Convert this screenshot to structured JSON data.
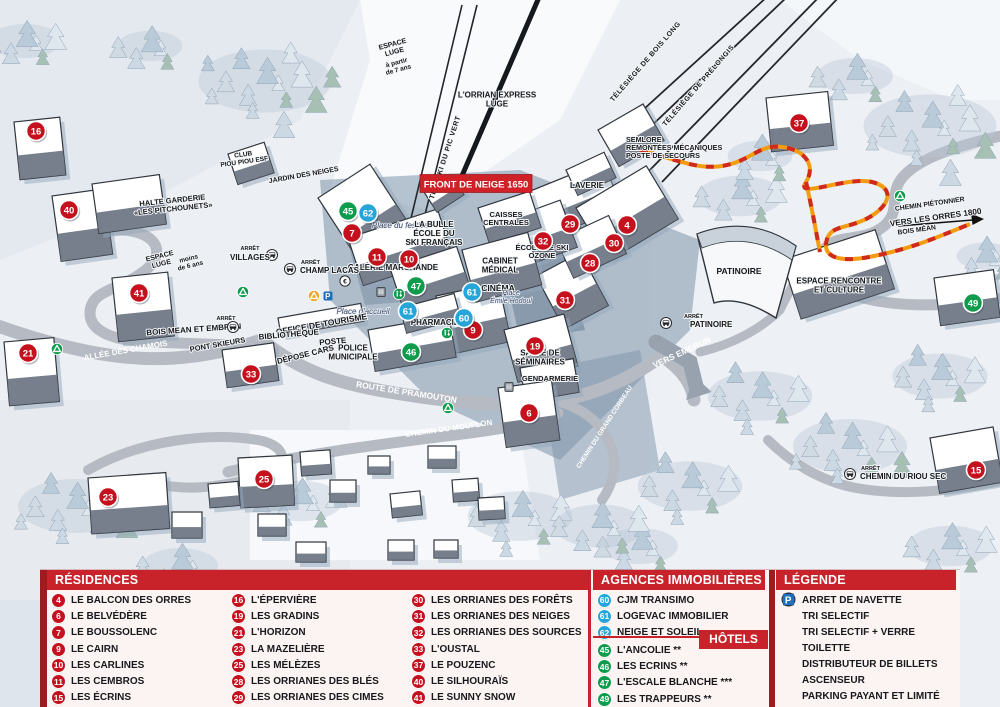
{
  "banner": {
    "text": "FRONT DE NEIGE 1650",
    "x": 476,
    "y": 184,
    "color": "#cf2128"
  },
  "arret_label": "ARRÊT",
  "colors": {
    "marker_red": "#c5111d",
    "marker_green": "#0e9c4c",
    "marker_blue": "#27a5d9",
    "header_red": "#c8232b",
    "dark_red": "#9e1b1f",
    "parking_blue": "#1e6fbd",
    "recycle_yellow": "#f0a52d",
    "path_orange": "#f39c12"
  },
  "map": {
    "labels": [
      {
        "t": [
          "ESPACE",
          "LUGE"
        ],
        "x": 394,
        "y": 50,
        "r": -15,
        "s": 7
      },
      {
        "t": [
          "à partir",
          "de 7 ans"
        ],
        "x": 398,
        "y": 68,
        "r": -15,
        "s": 6.5
      },
      {
        "t": [
          "TÉLÉSKI DU PIC VERT"
        ],
        "x": 447,
        "y": 158,
        "r": -72,
        "s": 7,
        "ls": 0.6
      },
      {
        "t": [
          "L'ORRIAN EXPRESS",
          "LUGE"
        ],
        "x": 497,
        "y": 102,
        "s": 8
      },
      {
        "t": [
          "TÉLÉSIÈGE DE BOIS LONG"
        ],
        "x": 647,
        "y": 63,
        "r": -49,
        "s": 7,
        "ls": 0.5
      },
      {
        "t": [
          "TÉLÉSIÈGE DE PRÉLONGIS"
        ],
        "x": 700,
        "y": 87,
        "r": -49,
        "s": 7,
        "ls": 0.5
      },
      {
        "t": [
          "SEMLORE",
          "REMONTÉES MÉCANIQUES",
          "POSTE DE SECOURS"
        ],
        "x": 626,
        "y": 150,
        "s": 7.2,
        "a": "start"
      },
      {
        "t": [
          "LAVERIE"
        ],
        "x": 587,
        "y": 188,
        "s": 8
      },
      {
        "t": [
          "HALTE GARDERIE",
          "«LES PITCHOUNETS»"
        ],
        "x": 173,
        "y": 207,
        "r": -6,
        "s": 7.5
      },
      {
        "t": [
          "CLUB",
          "PIOU PIOU ESF"
        ],
        "x": 244,
        "y": 160,
        "r": -8,
        "s": 6.5
      },
      {
        "t": [
          "JARDIN DES NEIGES"
        ],
        "x": 304,
        "y": 177,
        "r": -10,
        "s": 7
      },
      {
        "t": [
          "ESPACE",
          "LUGE"
        ],
        "x": 161,
        "y": 262,
        "r": -14,
        "s": 7
      },
      {
        "t": [
          "moins",
          "de 6 ans"
        ],
        "x": 190,
        "y": 264,
        "r": -14,
        "s": 6.5
      },
      {
        "t": [
          "Place du festival"
        ],
        "x": 401,
        "y": 228,
        "s": 8,
        "st": "p"
      },
      {
        "t": [
          "LA BULLE",
          "ÉCOLE DU",
          "SKI FRANÇAIS"
        ],
        "x": 434,
        "y": 236,
        "s": 8
      },
      {
        "t": [
          "CAISSES",
          "CENTRALES"
        ],
        "x": 506,
        "y": 221,
        "s": 7.5
      },
      {
        "t": [
          "GALERIE MARCHANDE"
        ],
        "x": 393,
        "y": 270,
        "s": 8
      },
      {
        "t": [
          "ÉCOLE DE SKI",
          "OZONE"
        ],
        "x": 542,
        "y": 254,
        "s": 7.5
      },
      {
        "t": [
          "CABINET",
          "MÉDICAL"
        ],
        "x": 500,
        "y": 268,
        "s": 8
      },
      {
        "t": [
          "CINÉMA"
        ],
        "x": 498,
        "y": 291,
        "s": 8.5
      },
      {
        "t": [
          "Place",
          "Émile Hodoul"
        ],
        "x": 511,
        "y": 299,
        "s": 7,
        "st": "p"
      },
      {
        "t": [
          "Place d'accueil"
        ],
        "x": 363,
        "y": 314,
        "s": 8,
        "st": "p"
      },
      {
        "t": [
          "OFFICE DE TOURISME"
        ],
        "x": 322,
        "y": 327,
        "r": -10,
        "s": 8.5
      },
      {
        "t": [
          "BIBLIOTHÈQUE"
        ],
        "x": 289,
        "y": 337,
        "r": -5,
        "s": 8
      },
      {
        "t": [
          "POSTE"
        ],
        "x": 333,
        "y": 344,
        "r": -5,
        "s": 8
      },
      {
        "t": [
          "DÉPOSE CARS"
        ],
        "x": 306,
        "y": 357,
        "r": -14,
        "s": 8
      },
      {
        "t": [
          "POLICE",
          "MUNICIPALE"
        ],
        "x": 353,
        "y": 355,
        "s": 8
      },
      {
        "t": [
          "PHARMACIE"
        ],
        "x": 435,
        "y": 325,
        "s": 8
      },
      {
        "t": [
          "SALLE DE",
          "SÉMINAIRES"
        ],
        "x": 540,
        "y": 360,
        "s": 8
      },
      {
        "t": [
          "GENDARMERIE"
        ],
        "x": 550,
        "y": 381,
        "s": 7.5
      },
      {
        "t": [
          "BOIS MEAN ET EMBRUN"
        ],
        "x": 194,
        "y": 332,
        "r": -4,
        "s": 8
      },
      {
        "t": [
          "PONT SKIEURS"
        ],
        "x": 218,
        "y": 347,
        "r": -10,
        "s": 7.5
      },
      {
        "t": [
          "ALLÉE DES CHAMOIS"
        ],
        "x": 126,
        "y": 353,
        "r": -10,
        "s": 8,
        "st": "w"
      },
      {
        "t": [
          "ROUTE DE PRAMOUTON"
        ],
        "x": 406,
        "y": 395,
        "r": 9,
        "s": 8.5,
        "st": "w"
      },
      {
        "t": [
          "CHEMIN DU MOUFLON"
        ],
        "x": 449,
        "y": 431,
        "r": -8,
        "s": 8,
        "st": "w"
      },
      {
        "t": [
          "CHEMIN DU GRAND CORBEAU"
        ],
        "x": 606,
        "y": 428,
        "r": -57,
        "s": 6.5,
        "st": "w"
      },
      {
        "t": [
          "VERS EMBRUN"
        ],
        "x": 683,
        "y": 355,
        "r": -25,
        "s": 8.5,
        "st": "w"
      },
      {
        "t": [
          "PATINOIRE"
        ],
        "x": 739,
        "y": 274,
        "s": 8.5
      },
      {
        "t": [
          "ESPACE RENCONTRE",
          "ET CULTURE"
        ],
        "x": 839,
        "y": 288,
        "s": 8
      },
      {
        "t": [
          "CHEMIN PIÉTONNIER"
        ],
        "x": 930,
        "y": 206,
        "r": -8,
        "s": 6.8
      },
      {
        "t": [
          "VERS LES ORRES 1800"
        ],
        "x": 936,
        "y": 220,
        "r": -8,
        "s": 8.2
      },
      {
        "t": [
          "BOIS MÉAN"
        ],
        "x": 917,
        "y": 232,
        "r": -8,
        "s": 6.8
      }
    ],
    "bus_stops": [
      {
        "name": "VILLAGES",
        "nx": 250,
        "ny": 260,
        "ax": 250,
        "ay": 250,
        "ix": 272,
        "iy": 255
      },
      {
        "name": "CHAMP LACAS",
        "nx": 300,
        "ny": 273,
        "ax": 301,
        "ay": 264,
        "ix": 290,
        "iy": 269,
        "a": "start"
      },
      {
        "name": "",
        "nx": 0,
        "ny": 0,
        "ax": 226,
        "ay": 320,
        "ix": 233,
        "iy": 327
      },
      {
        "name": "PATINOIRE",
        "nx": 690,
        "ny": 327,
        "ax": 684,
        "ay": 318,
        "ix": 666,
        "iy": 323,
        "a": "start"
      },
      {
        "name": "CHEMIN DU RIOU SEC",
        "nx": 860,
        "ny": 479,
        "ax": 861,
        "ay": 470,
        "ix": 850,
        "iy": 474,
        "a": "start"
      }
    ],
    "icons": [
      {
        "type": "recycle-green",
        "x": 243,
        "y": 292
      },
      {
        "type": "recycle-green",
        "x": 57,
        "y": 349
      },
      {
        "type": "recycle-green",
        "x": 448,
        "y": 408
      },
      {
        "type": "recycle-green",
        "x": 900,
        "y": 196
      },
      {
        "type": "recycle-yellow",
        "x": 314,
        "y": 296
      },
      {
        "type": "parking",
        "x": 328,
        "y": 296
      },
      {
        "type": "euro",
        "x": 345,
        "y": 281
      },
      {
        "type": "toilet",
        "x": 399,
        "y": 294
      },
      {
        "type": "toilet",
        "x": 447,
        "y": 333
      },
      {
        "type": "elevator",
        "x": 381,
        "y": 292
      },
      {
        "type": "elevator",
        "x": 509,
        "y": 387
      }
    ],
    "markers": [
      {
        "n": "16",
        "c": "red",
        "x": 36,
        "y": 131
      },
      {
        "n": "40",
        "c": "red",
        "x": 69,
        "y": 210
      },
      {
        "n": "41",
        "c": "red",
        "x": 139,
        "y": 293
      },
      {
        "n": "21",
        "c": "red",
        "x": 28,
        "y": 353
      },
      {
        "n": "23",
        "c": "red",
        "x": 108,
        "y": 497
      },
      {
        "n": "25",
        "c": "red",
        "x": 264,
        "y": 479
      },
      {
        "n": "33",
        "c": "red",
        "x": 251,
        "y": 374
      },
      {
        "n": "7",
        "c": "red",
        "x": 352,
        "y": 233
      },
      {
        "n": "11",
        "c": "red",
        "x": 377,
        "y": 257
      },
      {
        "n": "10",
        "c": "red",
        "x": 409,
        "y": 259
      },
      {
        "n": "9",
        "c": "red",
        "x": 473,
        "y": 330
      },
      {
        "n": "19",
        "c": "red",
        "x": 535,
        "y": 346
      },
      {
        "n": "6",
        "c": "red",
        "x": 529,
        "y": 413
      },
      {
        "n": "29",
        "c": "red",
        "x": 570,
        "y": 224
      },
      {
        "n": "4",
        "c": "red",
        "x": 627,
        "y": 225
      },
      {
        "n": "32",
        "c": "red",
        "x": 543,
        "y": 241
      },
      {
        "n": "30",
        "c": "red",
        "x": 614,
        "y": 243
      },
      {
        "n": "28",
        "c": "red",
        "x": 590,
        "y": 263
      },
      {
        "n": "31",
        "c": "red",
        "x": 565,
        "y": 300
      },
      {
        "n": "37",
        "c": "red",
        "x": 799,
        "y": 123
      },
      {
        "n": "15",
        "c": "red",
        "x": 976,
        "y": 470
      },
      {
        "n": "45",
        "c": "green",
        "x": 348,
        "y": 211
      },
      {
        "n": "47",
        "c": "green",
        "x": 416,
        "y": 286
      },
      {
        "n": "46",
        "c": "green",
        "x": 411,
        "y": 352
      },
      {
        "n": "49",
        "c": "green",
        "x": 973,
        "y": 303
      },
      {
        "n": "62",
        "c": "blue",
        "x": 368,
        "y": 213
      },
      {
        "n": "61",
        "c": "blue",
        "x": 408,
        "y": 311
      },
      {
        "n": "61",
        "c": "blue",
        "x": 472,
        "y": 292
      },
      {
        "n": "60",
        "c": "blue",
        "x": 464,
        "y": 318
      }
    ]
  },
  "panel": {
    "residences": {
      "title": "RÉSIDENCES",
      "columns": [
        [
          {
            "n": "4",
            "label": "LE BALCON DES ORRES"
          },
          {
            "n": "6",
            "label": "LE BELVÉDÈRE"
          },
          {
            "n": "7",
            "label": "LE BOUSSOLENC"
          },
          {
            "n": "9",
            "label": "LE CAIRN"
          },
          {
            "n": "10",
            "label": "LES CARLINES"
          },
          {
            "n": "11",
            "label": "LES CEMBROS"
          },
          {
            "n": "15",
            "label": "LES ÉCRINS"
          }
        ],
        [
          {
            "n": "16",
            "label": "L'ÉPERVIÈRE"
          },
          {
            "n": "19",
            "label": "LES GRADINS"
          },
          {
            "n": "21",
            "label": "L'HORIZON"
          },
          {
            "n": "23",
            "label": "LA MAZELIÈRE"
          },
          {
            "n": "25",
            "label": "LES MÉLÈZES"
          },
          {
            "n": "28",
            "label": "LES ORRIANES DES BLÉS"
          },
          {
            "n": "29",
            "label": "LES ORRIANES DES CIMES"
          }
        ],
        [
          {
            "n": "30",
            "label": "LES ORRIANES DES FORÊTS"
          },
          {
            "n": "31",
            "label": "LES ORRIANES DES NEIGES"
          },
          {
            "n": "32",
            "label": "LES ORRIANES DES SOURCES"
          },
          {
            "n": "33",
            "label": "L'OUSTAL"
          },
          {
            "n": "37",
            "label": "LE POUZENC"
          },
          {
            "n": "40",
            "label": "LE SILHOURAÏS"
          },
          {
            "n": "41",
            "label": "LE SUNNY SNOW"
          }
        ]
      ]
    },
    "agences": {
      "title": "AGENCES IMMOBILIÈRES",
      "items": [
        {
          "n": "60",
          "label": "CJM TRANSIMO"
        },
        {
          "n": "61",
          "label": "LOGEVAC IMMOBILIER"
        },
        {
          "n": "62",
          "label": "NEIGE ET SOLEIL"
        }
      ]
    },
    "hotels": {
      "title": "HÔTELS",
      "items": [
        {
          "n": "45",
          "label": "L'ANCOLIE **"
        },
        {
          "n": "46",
          "label": "LES ECRINS **"
        },
        {
          "n": "47",
          "label": "L'ESCALE BLANCHE ***"
        },
        {
          "n": "49",
          "label": "LES TRAPPEURS **"
        }
      ]
    },
    "legende": {
      "title": "LÉGENDE",
      "items": [
        {
          "icon": "bus",
          "label": "ARRET DE NAVETTE"
        },
        {
          "icon": "recycle-green",
          "label": "TRI SELECTIF"
        },
        {
          "icon": "recycle-yellow",
          "label": "TRI SELECTIF + VERRE"
        },
        {
          "icon": "toilet",
          "label": "TOILETTE"
        },
        {
          "icon": "euro",
          "label": "DISTRIBUTEUR DE BILLETS"
        },
        {
          "icon": "elevator",
          "label": "ASCENSEUR"
        },
        {
          "icon": "parking",
          "label": "PARKING PAYANT ET LIMITÉ"
        }
      ]
    }
  },
  "icon_glyphs": {
    "parking": "P",
    "euro": "€"
  }
}
